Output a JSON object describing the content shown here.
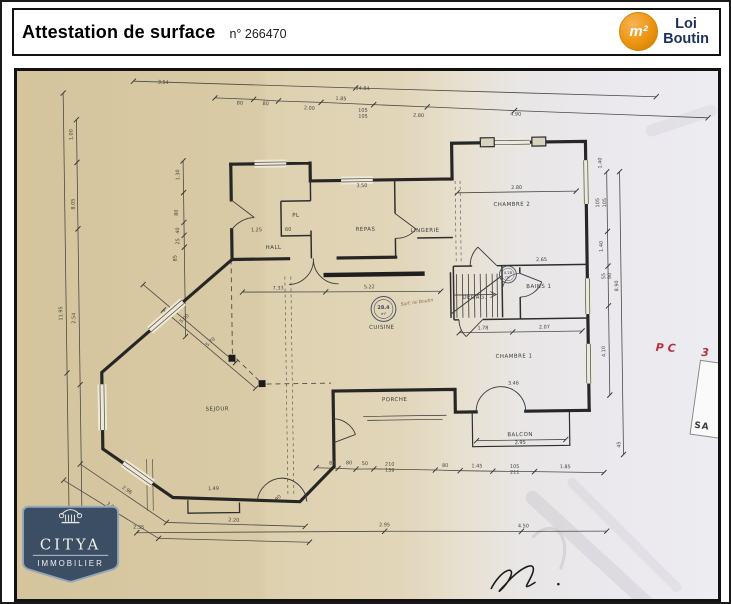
{
  "header": {
    "title": "Attestation de surface",
    "number": "n° 266470",
    "badge": {
      "symbol": "m²",
      "line1": "Loi",
      "line2": "Boutin"
    }
  },
  "colors": {
    "accent_orange": "#ec9410",
    "navy": "#1c2f5e",
    "red_annotation": "#b23343",
    "logo_slate": "#3c4e63",
    "paper_left": "#dccdaa",
    "paper_right": "#edecf1"
  },
  "logo": {
    "name": "CITYA",
    "subtitle": "IMMOBILIER"
  },
  "plan": {
    "handwriting": "Surf. loi Boutin",
    "red_note": {
      "a": "PC",
      "b": "3"
    },
    "side_stamp": "SA",
    "stamp_large": {
      "value": "28.4",
      "unit": "m²"
    },
    "stamp_small": {
      "value": "4.28",
      "unit": "m²"
    },
    "labels": [
      {
        "t": "HALL",
        "x": 260,
        "y": 178
      },
      {
        "t": "PL",
        "x": 283,
        "y": 146
      },
      {
        "t": "REPAS",
        "x": 353,
        "y": 161
      },
      {
        "t": "LINGERIE",
        "x": 413,
        "y": 163
      },
      {
        "t": "CHAMBRE 2",
        "x": 501,
        "y": 138
      },
      {
        "t": "DEGAG.",
        "x": 462,
        "y": 231
      },
      {
        "t": "BAINS 1",
        "x": 527,
        "y": 221
      },
      {
        "t": "CHAMBRE 1",
        "x": 501,
        "y": 291
      },
      {
        "t": "BALCON",
        "x": 506,
        "y": 370
      },
      {
        "t": "SEJOUR",
        "x": 201,
        "y": 340
      },
      {
        "t": "CUISINE",
        "x": 368,
        "y": 260
      },
      {
        "t": "PORCHE",
        "x": 380,
        "y": 333
      }
    ],
    "dims": [
      {
        "t": "3.54",
        "x": 151,
        "y": 10,
        "r": 3
      },
      {
        "t": "14.84",
        "x": 352,
        "y": 19,
        "r": 3
      },
      {
        "t": "1.85",
        "x": 330,
        "y": 29,
        "r": 3
      },
      {
        "t": "80",
        "x": 228,
        "y": 32,
        "r": 3
      },
      {
        "t": "80",
        "x": 254,
        "y": 33,
        "r": 3
      },
      {
        "t": "2.00",
        "x": 298,
        "y": 38,
        "r": 3
      },
      {
        "t": "105",
        "x": 352,
        "y": 41,
        "r": 3
      },
      {
        "t": "105",
        "x": 352,
        "y": 47,
        "r": 3
      },
      {
        "t": "2.80",
        "x": 408,
        "y": 47,
        "r": 3
      },
      {
        "t": "4.90",
        "x": 506,
        "y": 47,
        "r": 3
      },
      {
        "t": "11.95",
        "x": 46,
        "y": 240,
        "r": -90
      },
      {
        "t": "1.00",
        "x": 59,
        "y": 60,
        "r": -90
      },
      {
        "t": "8.05",
        "x": 60,
        "y": 130,
        "r": -90
      },
      {
        "t": "2.54",
        "x": 59,
        "y": 245,
        "r": -90
      },
      {
        "t": "1.30",
        "x": 166,
        "y": 102,
        "r": -90
      },
      {
        "t": "80",
        "x": 164,
        "y": 140,
        "r": -90
      },
      {
        "t": "40",
        "x": 165,
        "y": 158,
        "r": -90
      },
      {
        "t": "25",
        "x": 165,
        "y": 169,
        "r": -90
      },
      {
        "t": "85",
        "x": 162,
        "y": 186,
        "r": -90
      },
      {
        "t": "5.00",
        "x": 170,
        "y": 248,
        "r": -41
      },
      {
        "t": "5.70",
        "x": 196,
        "y": 272,
        "r": -41
      },
      {
        "t": "2.96",
        "x": 108,
        "y": 420,
        "r": 36
      },
      {
        "t": "3.00",
        "x": 92,
        "y": 436,
        "r": 36
      },
      {
        "t": "2.20",
        "x": 216,
        "y": 452,
        "r": 3
      },
      {
        "t": "90",
        "x": 262,
        "y": 430,
        "r": -40
      },
      {
        "t": "1.49",
        "x": 196,
        "y": 420,
        "r": 0
      },
      {
        "t": "80",
        "x": 316,
        "y": 396,
        "r": 2
      },
      {
        "t": "80",
        "x": 333,
        "y": 396,
        "r": 2
      },
      {
        "t": "50",
        "x": 349,
        "y": 397,
        "r": 2
      },
      {
        "t": "210",
        "x": 374,
        "y": 398,
        "r": 2
      },
      {
        "t": "139",
        "x": 374,
        "y": 404,
        "r": 2
      },
      {
        "t": "80",
        "x": 430,
        "y": 400,
        "r": 2
      },
      {
        "t": "1.45",
        "x": 462,
        "y": 401,
        "r": 2
      },
      {
        "t": "105",
        "x": 500,
        "y": 402,
        "r": 2
      },
      {
        "t": "211",
        "x": 500,
        "y": 408,
        "r": 2
      },
      {
        "t": "1.85",
        "x": 551,
        "y": 403,
        "r": 2
      },
      {
        "t": "2.35",
        "x": 120,
        "y": 458,
        "r": 2
      },
      {
        "t": "2.95",
        "x": 368,
        "y": 459,
        "r": 2
      },
      {
        "t": "4.50",
        "x": 508,
        "y": 462,
        "r": 2
      },
      {
        "t": "1.40",
        "x": 592,
        "y": 96,
        "r": -90
      },
      {
        "t": "105",
        "x": 589,
        "y": 136,
        "r": -90
      },
      {
        "t": "105",
        "x": 596,
        "y": 136,
        "r": -90
      },
      {
        "t": "1.40",
        "x": 592,
        "y": 180,
        "r": -90
      },
      {
        "t": "55",
        "x": 594,
        "y": 210,
        "r": -90
      },
      {
        "t": "90",
        "x": 600,
        "y": 210,
        "r": -90
      },
      {
        "t": "4.10",
        "x": 593,
        "y": 286,
        "r": -90
      },
      {
        "t": "8.90",
        "x": 607,
        "y": 220,
        "r": -90
      },
      {
        "t": "45",
        "x": 607,
        "y": 380,
        "r": -90
      },
      {
        "t": "3.50",
        "x": 350,
        "y": 117,
        "r": 0
      },
      {
        "t": "2.80",
        "x": 506,
        "y": 121,
        "r": 0
      },
      {
        "t": "2.65",
        "x": 530,
        "y": 194,
        "r": 0
      },
      {
        "t": "1.25",
        "x": 243,
        "y": 160,
        "r": 0
      },
      {
        "t": "60",
        "x": 275,
        "y": 160,
        "r": 0
      },
      {
        "t": "7.33",
        "x": 264,
        "y": 219,
        "r": 0
      },
      {
        "t": "5.22",
        "x": 356,
        "y": 219,
        "r": 0
      },
      {
        "t": "1.78",
        "x": 470,
        "y": 262,
        "r": 0
      },
      {
        "t": "2.07",
        "x": 532,
        "y": 262,
        "r": 0
      },
      {
        "t": "3.46",
        "x": 500,
        "y": 318,
        "r": 0
      },
      {
        "t": "2.95",
        "x": 506,
        "y": 378,
        "r": 0
      }
    ]
  }
}
